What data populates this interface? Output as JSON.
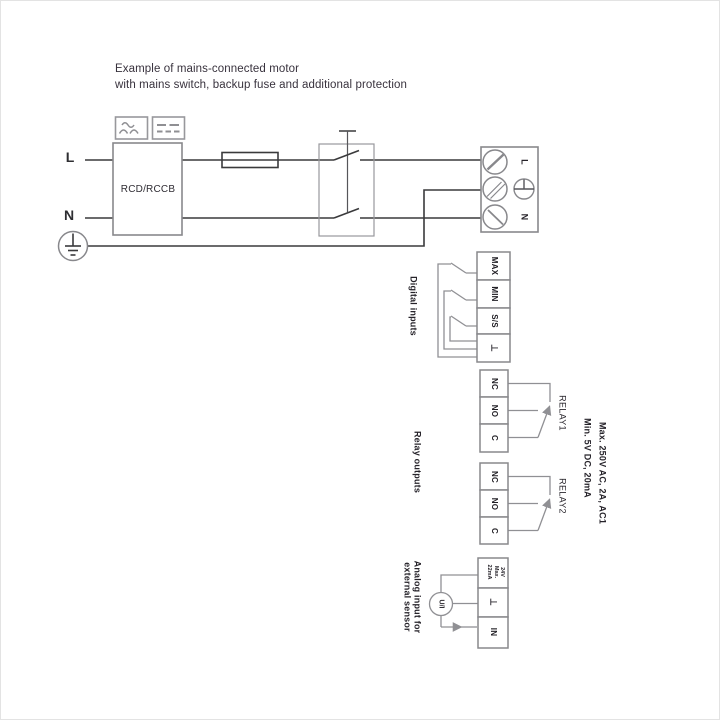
{
  "colors": {
    "wire_dark": "#3a3a3c",
    "wire_gray": "#909094",
    "border_gray": "#88888c",
    "text": "#29262c"
  },
  "title": {
    "line1": "Example of mains-connected motor",
    "line2": "with mains switch, backup fuse and additional protection"
  },
  "mains": {
    "phase_label": "L",
    "neutral_label": "N",
    "rcd_label": "RCD/RCCB",
    "terminal_labels": {
      "phase": "L",
      "neutral": "N"
    }
  },
  "digital_inputs": {
    "section_label": "Digital inputs",
    "terminals": [
      "MAX",
      "MIN",
      "S/S",
      "⊥"
    ]
  },
  "relay_outputs": {
    "section_label": "Relay outputs",
    "relays": [
      {
        "name": "RELAY1",
        "terminals": [
          "NC",
          "NO",
          "C"
        ]
      },
      {
        "name": "RELAY2",
        "terminals": [
          "NC",
          "NO",
          "C"
        ]
      }
    ],
    "rating_max": "Max. 250V AC, 2A, AC1",
    "rating_min": "Min. 5V DC, 20mA"
  },
  "analog_input": {
    "section_label_line1": "Analog input for",
    "section_label_line2": "external sensor",
    "supply_label": [
      "24V",
      "Max.",
      "22mA"
    ],
    "ground_label": "⊥",
    "input_label": "IN",
    "transducer_label": "U/I"
  }
}
